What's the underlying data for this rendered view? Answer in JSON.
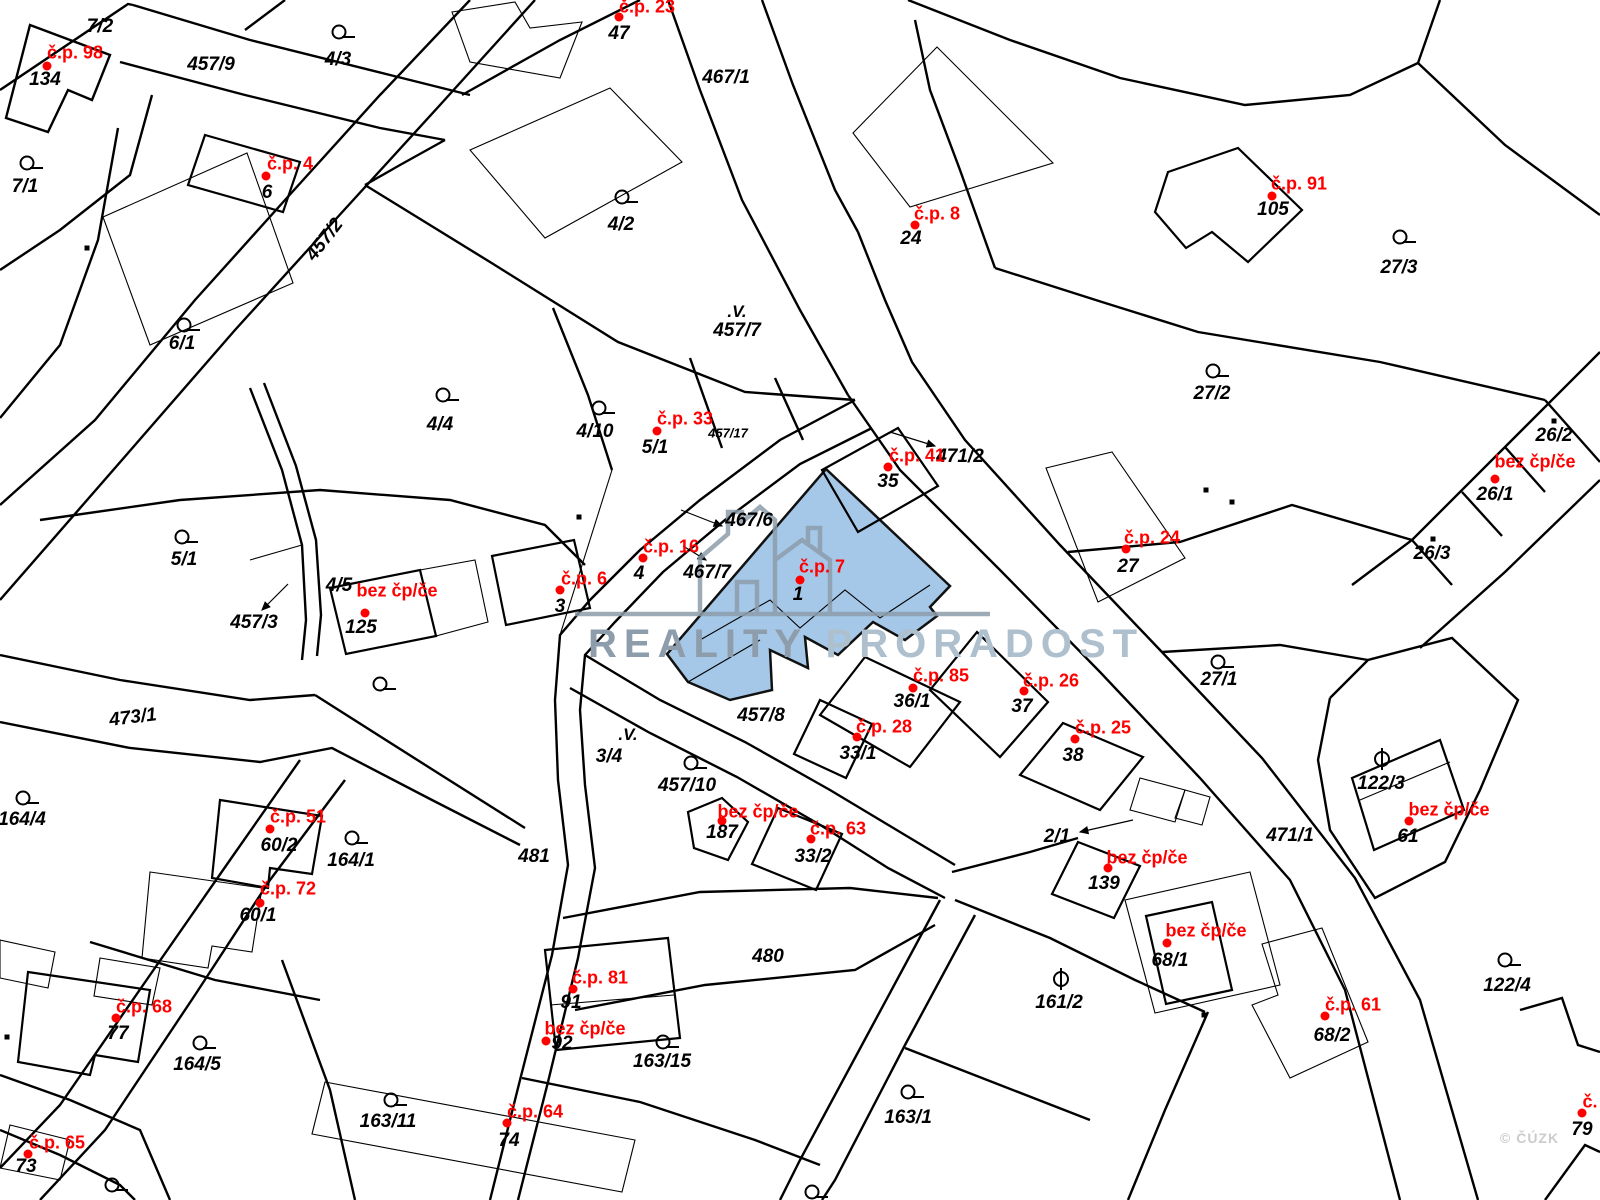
{
  "map": {
    "type": "cadastral-parcel-map",
    "colors": {
      "boundary": "#000000",
      "building_label": "#ff0000",
      "highlight_fill": "#a6c8e8",
      "watermark_primary": "#8d9dab",
      "watermark_secondary": "#aebfcd",
      "copyright_gray": "#cccccc"
    },
    "watermark": {
      "brand_primary": "REALITY",
      "brand_secondary": "PRORADOST",
      "copyright": "© ČÚZK"
    },
    "highlight": {
      "building_label": "č.p. 7",
      "parcel_number": "1"
    },
    "red_labels": [
      {
        "t": "č.p. 98",
        "x": 75,
        "y": 53
      },
      {
        "t": "č.p. 4",
        "x": 290,
        "y": 164
      },
      {
        "t": "č.p. 23",
        "x": 647,
        "y": 7
      },
      {
        "t": "č.p. 8",
        "x": 937,
        "y": 214
      },
      {
        "t": "č.p. 91",
        "x": 1299,
        "y": 184
      },
      {
        "t": "č.p. 33",
        "x": 685,
        "y": 419
      },
      {
        "t": "č.p. 41",
        "x": 917,
        "y": 456
      },
      {
        "t": "bez čp/če",
        "x": 1535,
        "y": 462
      },
      {
        "t": "č.p. 16",
        "x": 671,
        "y": 547
      },
      {
        "t": "č.p. 6",
        "x": 584,
        "y": 579
      },
      {
        "t": "č.p. 7",
        "x": 822,
        "y": 567
      },
      {
        "t": "č.p. 24",
        "x": 1152,
        "y": 538
      },
      {
        "t": "bez čp/če",
        "x": 397,
        "y": 591
      },
      {
        "t": "č.p. 85",
        "x": 941,
        "y": 676
      },
      {
        "t": "č.p. 26",
        "x": 1051,
        "y": 681
      },
      {
        "t": "č.p. 28",
        "x": 884,
        "y": 727
      },
      {
        "t": "č.p. 25",
        "x": 1103,
        "y": 728
      },
      {
        "t": "bez čp/če",
        "x": 758,
        "y": 812
      },
      {
        "t": "bez čp/če",
        "x": 1449,
        "y": 810
      },
      {
        "t": "č.p. 63",
        "x": 838,
        "y": 829
      },
      {
        "t": "bez čp/če",
        "x": 1147,
        "y": 858
      },
      {
        "t": "č.p. 51",
        "x": 298,
        "y": 817
      },
      {
        "t": "č.p. 72",
        "x": 288,
        "y": 889
      },
      {
        "t": "č.p. 68",
        "x": 144,
        "y": 1007
      },
      {
        "t": "č.p. 81",
        "x": 600,
        "y": 978
      },
      {
        "t": "bez čp/če",
        "x": 585,
        "y": 1029
      },
      {
        "t": "bez čp/če",
        "x": 1206,
        "y": 931
      },
      {
        "t": "č.p. 64",
        "x": 535,
        "y": 1112
      },
      {
        "t": "č.p. 65",
        "x": 57,
        "y": 1143
      },
      {
        "t": "č.p. 61",
        "x": 1353,
        "y": 1005
      },
      {
        "t": "č.",
        "x": 1590,
        "y": 1102
      }
    ],
    "black_labels": [
      {
        "t": "7/2",
        "x": 100,
        "y": 27
      },
      {
        "t": "457/9",
        "x": 211,
        "y": 65
      },
      {
        "t": "4/3",
        "x": 338,
        "y": 60
      },
      {
        "t": "134",
        "x": 45,
        "y": 80
      },
      {
        "t": "7/1",
        "x": 25,
        "y": 187
      },
      {
        "t": "6",
        "x": 267,
        "y": 193
      },
      {
        "t": "457/2",
        "x": 325,
        "y": 240,
        "r": -52
      },
      {
        "t": "47",
        "x": 619,
        "y": 34
      },
      {
        "t": "467/1",
        "x": 726,
        "y": 78
      },
      {
        "t": "4/2",
        "x": 621,
        "y": 225
      },
      {
        "t": "24",
        "x": 911,
        "y": 239
      },
      {
        "t": "105",
        "x": 1273,
        "y": 210
      },
      {
        "t": "27/3",
        "x": 1399,
        "y": 268
      },
      {
        "t": "457/7",
        "x": 737,
        "y": 331
      },
      {
        "t": "6/1",
        "x": 182,
        "y": 344
      },
      {
        "t": "4/4",
        "x": 440,
        "y": 425
      },
      {
        "t": "4/10",
        "x": 595,
        "y": 432
      },
      {
        "t": "5/1",
        "x": 655,
        "y": 448
      },
      {
        "t": "457/17",
        "x": 728,
        "y": 433,
        "s": 1
      },
      {
        "t": "27/2",
        "x": 1212,
        "y": 394
      },
      {
        "t": "35",
        "x": 888,
        "y": 482
      },
      {
        "t": "471/2",
        "x": 960,
        "y": 457
      },
      {
        "t": "26/2",
        "x": 1554,
        "y": 436
      },
      {
        "t": "26/1",
        "x": 1495,
        "y": 495
      },
      {
        "t": "5/1",
        "x": 184,
        "y": 560
      },
      {
        "t": "4/5",
        "x": 339,
        "y": 586
      },
      {
        "t": "457/3",
        "x": 254,
        "y": 623
      },
      {
        "t": "125",
        "x": 361,
        "y": 628
      },
      {
        "t": "3",
        "x": 560,
        "y": 607
      },
      {
        "t": "4",
        "x": 639,
        "y": 574
      },
      {
        "t": "467/6",
        "x": 749,
        "y": 521
      },
      {
        "t": "467/7",
        "x": 707,
        "y": 573
      },
      {
        "t": "1",
        "x": 798,
        "y": 595
      },
      {
        "t": "27",
        "x": 1128,
        "y": 567
      },
      {
        "t": "26/3",
        "x": 1432,
        "y": 554
      },
      {
        "t": "27/1",
        "x": 1219,
        "y": 680
      },
      {
        "t": "457/8",
        "x": 761,
        "y": 716
      },
      {
        "t": "36/1",
        "x": 912,
        "y": 702
      },
      {
        "t": "37",
        "x": 1022,
        "y": 707
      },
      {
        "t": "33/1",
        "x": 858,
        "y": 754
      },
      {
        "t": "38",
        "x": 1073,
        "y": 756
      },
      {
        "t": "3/4",
        "x": 609,
        "y": 757
      },
      {
        "t": "457/10",
        "x": 687,
        "y": 786
      },
      {
        "t": "187",
        "x": 722,
        "y": 833
      },
      {
        "t": "33/2",
        "x": 813,
        "y": 857
      },
      {
        "t": "2/1",
        "x": 1057,
        "y": 837
      },
      {
        "t": "139",
        "x": 1104,
        "y": 884
      },
      {
        "t": "122/3",
        "x": 1381,
        "y": 784
      },
      {
        "t": "61",
        "x": 1408,
        "y": 837
      },
      {
        "t": "471/1",
        "x": 1290,
        "y": 836
      },
      {
        "t": "473/1",
        "x": 133,
        "y": 718,
        "r": -7
      },
      {
        "t": "164/4",
        "x": 22,
        "y": 820
      },
      {
        "t": "60/2",
        "x": 279,
        "y": 846
      },
      {
        "t": "164/1",
        "x": 351,
        "y": 861
      },
      {
        "t": "60/1",
        "x": 258,
        "y": 916
      },
      {
        "t": "481",
        "x": 534,
        "y": 857
      },
      {
        "t": "480",
        "x": 768,
        "y": 957
      },
      {
        "t": "91",
        "x": 571,
        "y": 1003
      },
      {
        "t": "92",
        "x": 562,
        "y": 1044
      },
      {
        "t": "163/15",
        "x": 662,
        "y": 1062
      },
      {
        "t": "77",
        "x": 118,
        "y": 1034
      },
      {
        "t": "164/5",
        "x": 197,
        "y": 1065
      },
      {
        "t": "74",
        "x": 509,
        "y": 1141
      },
      {
        "t": "163/11",
        "x": 388,
        "y": 1122
      },
      {
        "t": "73",
        "x": 26,
        "y": 1167
      },
      {
        "t": "161/2",
        "x": 1059,
        "y": 1003
      },
      {
        "t": "163/1",
        "x": 908,
        "y": 1118
      },
      {
        "t": "68/1",
        "x": 1170,
        "y": 961
      },
      {
        "t": "68/2",
        "x": 1332,
        "y": 1036
      },
      {
        "t": "122/4",
        "x": 1507,
        "y": 986
      },
      {
        "t": "79",
        "x": 1582,
        "y": 1130
      }
    ],
    "red_dots": [
      [
        47,
        66
      ],
      [
        266,
        176
      ],
      [
        619,
        17
      ],
      [
        915,
        225
      ],
      [
        1272,
        196
      ],
      [
        657,
        431
      ],
      [
        888,
        467
      ],
      [
        643,
        558
      ],
      [
        560,
        590
      ],
      [
        800,
        580
      ],
      [
        1126,
        549
      ],
      [
        1495,
        479
      ],
      [
        365,
        613
      ],
      [
        270,
        829
      ],
      [
        913,
        688
      ],
      [
        1024,
        691
      ],
      [
        857,
        737
      ],
      [
        1075,
        739
      ],
      [
        811,
        839
      ],
      [
        722,
        821
      ],
      [
        1108,
        868
      ],
      [
        1409,
        821
      ],
      [
        260,
        903
      ],
      [
        116,
        1018
      ],
      [
        573,
        989
      ],
      [
        546,
        1041
      ],
      [
        507,
        1123
      ],
      [
        28,
        1154
      ],
      [
        1167,
        943
      ],
      [
        1325,
        1016
      ],
      [
        1582,
        1113
      ]
    ],
    "circle_symbols": [
      [
        339,
        32
      ],
      [
        27,
        163
      ],
      [
        622,
        197
      ],
      [
        1400,
        237
      ],
      [
        184,
        325
      ],
      [
        443,
        395
      ],
      [
        599,
        408
      ],
      [
        182,
        537
      ],
      [
        1213,
        371
      ],
      [
        1218,
        662
      ],
      [
        380,
        684
      ],
      [
        23,
        798
      ],
      [
        352,
        838
      ],
      [
        200,
        1043
      ],
      [
        691,
        763
      ],
      [
        663,
        1042
      ],
      [
        908,
        1092
      ],
      [
        391,
        1100
      ],
      [
        1505,
        960
      ],
      [
        112,
        1185
      ],
      [
        812,
        1192
      ]
    ],
    "theta_symbols": [
      [
        1382,
        759
      ],
      [
        1061,
        979
      ]
    ],
    "v_symbols": [
      {
        "t": ".V.",
        "x": 737,
        "y": 312
      },
      {
        "t": ".V.",
        "x": 628,
        "y": 735
      }
    ],
    "square_dots": [
      [
        87,
        248
      ],
      [
        579,
        517
      ],
      [
        1232,
        502
      ],
      [
        1554,
        421
      ],
      [
        1433,
        539
      ],
      [
        1206,
        490
      ],
      [
        7,
        1037
      ],
      [
        1204,
        1015
      ]
    ],
    "arrows": [
      [
        681,
        510,
        722,
        526
      ],
      [
        683,
        546,
        706,
        560
      ],
      [
        890,
        432,
        935,
        446
      ],
      [
        288,
        584,
        262,
        610
      ],
      [
        1133,
        820,
        1080,
        832
      ]
    ]
  }
}
